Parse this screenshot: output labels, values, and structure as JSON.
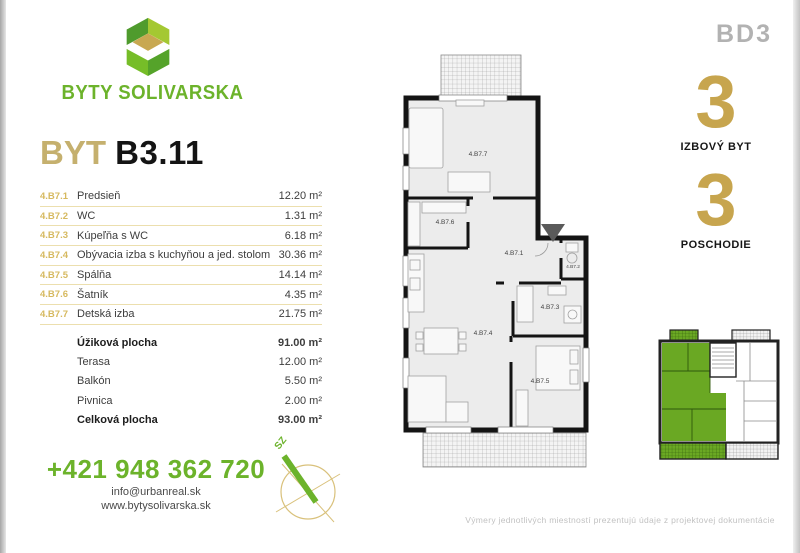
{
  "brand": {
    "name": "BYTY SOLIVARSKA"
  },
  "badge": {
    "building": "BD3"
  },
  "title": {
    "prefix": "BYT",
    "unit": "B3.11"
  },
  "rooms": [
    {
      "code": "4.B7.1",
      "name": "Predsieň",
      "area": "12.20 m²"
    },
    {
      "code": "4.B7.2",
      "name": "WC",
      "area": "1.31 m²"
    },
    {
      "code": "4.B7.3",
      "name": "Kúpeľňa s WC",
      "area": "6.18 m²"
    },
    {
      "code": "4.B7.4",
      "name": "Obývacia izba s kuchyňou a jed. stolom",
      "area": "30.36 m²"
    },
    {
      "code": "4.B7.5",
      "name": "Spálňa",
      "area": "14.14 m²"
    },
    {
      "code": "4.B7.6",
      "name": "Šatník",
      "area": "4.35 m²"
    },
    {
      "code": "4.B7.7",
      "name": "Detská izba",
      "area": "21.75 m²"
    }
  ],
  "summary": [
    {
      "name": "Úžiková plocha",
      "area": "91.00 m²",
      "bold": true
    },
    {
      "name": "Terasa",
      "area": "12.00 m²",
      "bold": false
    },
    {
      "name": "Balkón",
      "area": "5.50 m²",
      "bold": false
    },
    {
      "name": "Pivnica",
      "area": "2.00 m²",
      "bold": false
    },
    {
      "name": "Celková plocha",
      "area": "93.00 m²",
      "bold": true
    }
  ],
  "facts": [
    {
      "value": "3",
      "label": "IZBOVÝ BYT"
    },
    {
      "value": "3",
      "label": "POSCHODIE"
    }
  ],
  "contact": {
    "phone": "+421 948 362 720",
    "email": "info@urbanreal.sk",
    "website": "www.bytysolivarska.sk"
  },
  "compass": {
    "direction_label": "SZ"
  },
  "disclaimer": "Výmery jednotlivých miestností prezentujú údaje z projektovej dokumentácie",
  "colors": {
    "brand_green": "#6cb32b",
    "gold": "#c7a54e",
    "table_line": "#ecdfae",
    "badge_gray": "#b2b2b2",
    "wall_black": "#141414",
    "room_fill": "#ececec",
    "keyplan_green": "#6aa823"
  }
}
